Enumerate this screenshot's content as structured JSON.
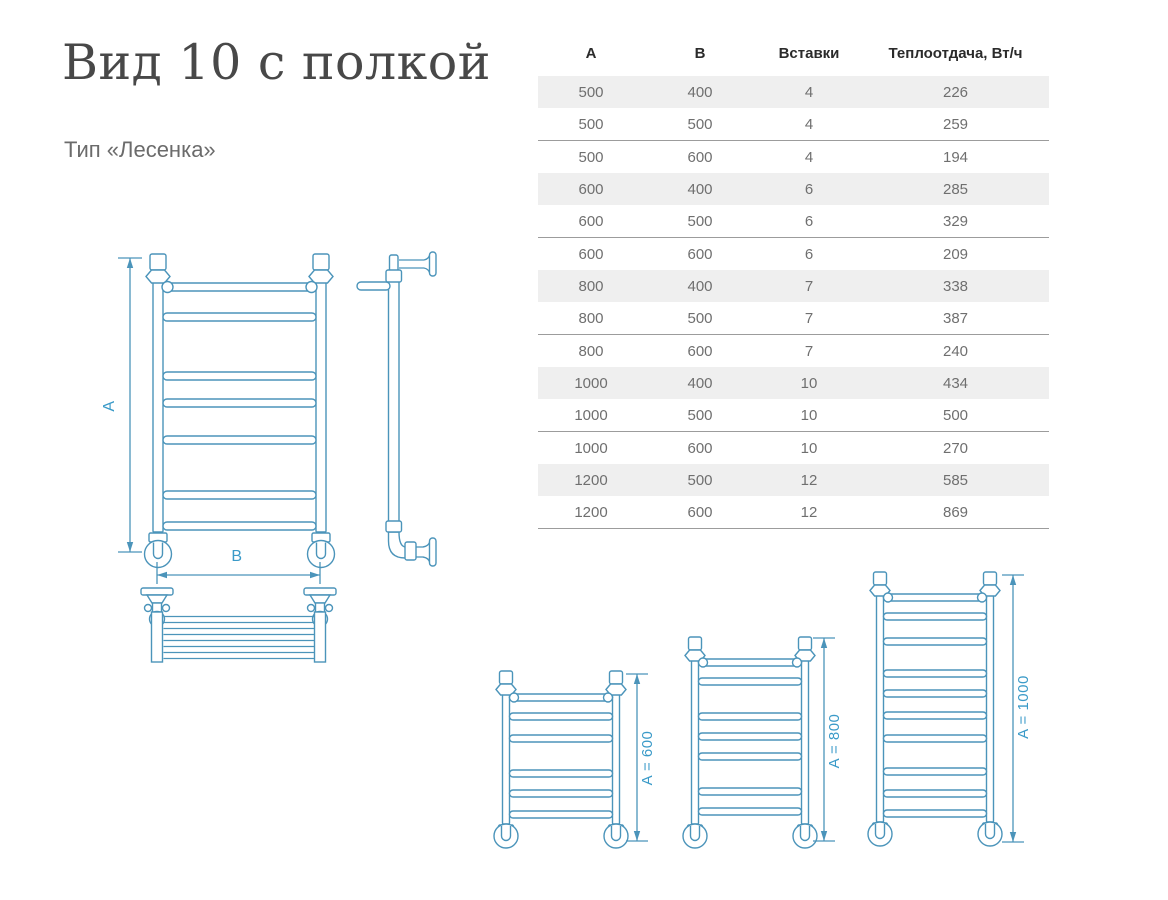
{
  "page": {
    "title": "Вид 10 с полкой",
    "subtitle": "Тип «Лесенка»"
  },
  "table": {
    "headers": [
      "A",
      "B",
      "Вставки",
      "Теплоотдача, Вт/ч"
    ],
    "rows": [
      [
        "500",
        "400",
        "4",
        "226"
      ],
      [
        "500",
        "500",
        "4",
        "259"
      ],
      [
        "500",
        "600",
        "4",
        "194"
      ],
      [
        "600",
        "400",
        "6",
        "285"
      ],
      [
        "600",
        "500",
        "6",
        "329"
      ],
      [
        "600",
        "600",
        "6",
        "209"
      ],
      [
        "800",
        "400",
        "7",
        "338"
      ],
      [
        "800",
        "500",
        "7",
        "387"
      ],
      [
        "800",
        "600",
        "7",
        "240"
      ],
      [
        "1000",
        "400",
        "10",
        "434"
      ],
      [
        "1000",
        "500",
        "10",
        "500"
      ],
      [
        "1000",
        "600",
        "10",
        "270"
      ],
      [
        "1200",
        "500",
        "12",
        "585"
      ],
      [
        "1200",
        "600",
        "12",
        "869"
      ]
    ]
  },
  "drawings": {
    "front_view": {
      "height_label": "A",
      "width_label": "B"
    },
    "size_variants": [
      {
        "label": "A = 600"
      },
      {
        "label": "A = 800"
      },
      {
        "label": "A = 1000"
      }
    ]
  },
  "colors": {
    "drawing_blue": "#4b94ba",
    "dimension_text_blue": "#3a9ac8",
    "table_row_alt_bg": "#efefef",
    "table_separator": "#9c9c9c",
    "table_header_text": "#2b2b2b",
    "table_cell_text": "#6f6f6f",
    "title_text": "#484848",
    "subtitle_text": "#6b6b6b"
  }
}
